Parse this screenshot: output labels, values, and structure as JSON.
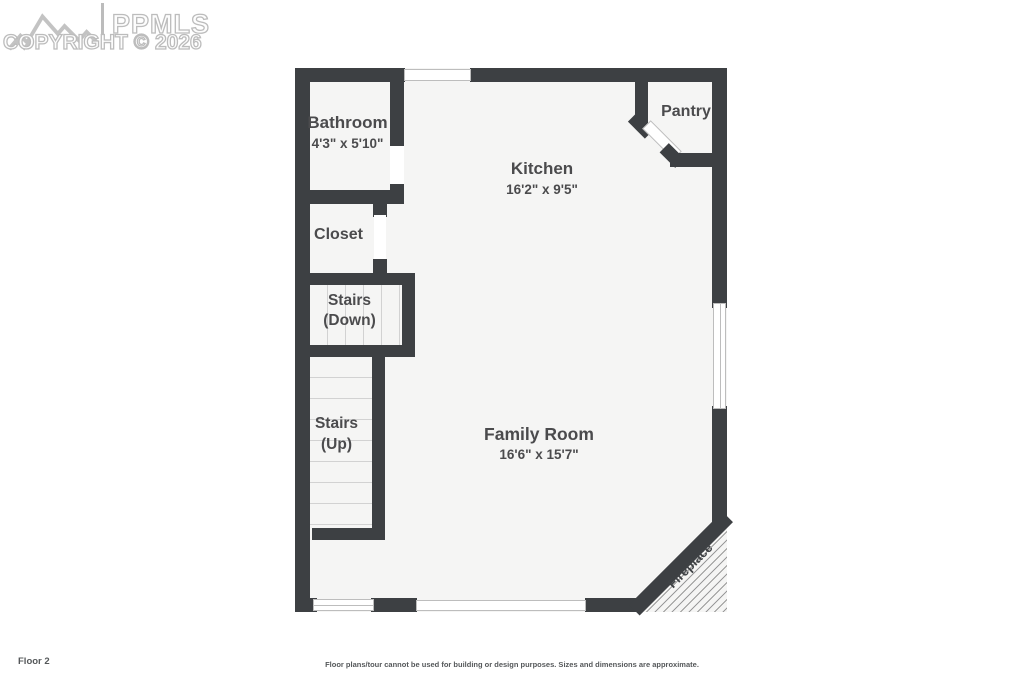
{
  "watermark": {
    "brand": "PPMLS",
    "copyright": "COPYRIGHT © 2026"
  },
  "rooms": {
    "bathroom": {
      "name": "Bathroom",
      "dimensions": "4'3\" x 5'10\""
    },
    "kitchen": {
      "name": "Kitchen",
      "dimensions": "16'2\" x 9'5\""
    },
    "pantry": {
      "name": "Pantry"
    },
    "closet": {
      "name": "Closet"
    },
    "stairs_down": {
      "line1": "Stairs",
      "line2": "(Down)"
    },
    "stairs_up": {
      "line1": "Stairs",
      "line2": "(Up)"
    },
    "family_room": {
      "name": "Family Room",
      "dimensions": "16'6\" x 15'7\""
    },
    "fireplace": {
      "name": "Fireplace"
    }
  },
  "features": {
    "windows": [
      "top-wall-window",
      "right-wall-window",
      "bottom-wall-window",
      "bottom-wall-slider"
    ],
    "doors": [
      "bathroom-door-opening",
      "closet-door-opening",
      "pantry-diagonal-door-opening"
    ]
  },
  "footer": {
    "floor_label": "Floor 2",
    "disclaimer": "Floor plans/tour cannot be used for building or design purposes. Sizes and dimensions are approximate."
  },
  "colors": {
    "wall": "#3d4043",
    "floor": "#f5f5f4",
    "label": "#4b4b4d",
    "watermark_outline": "#bcbcbc"
  }
}
